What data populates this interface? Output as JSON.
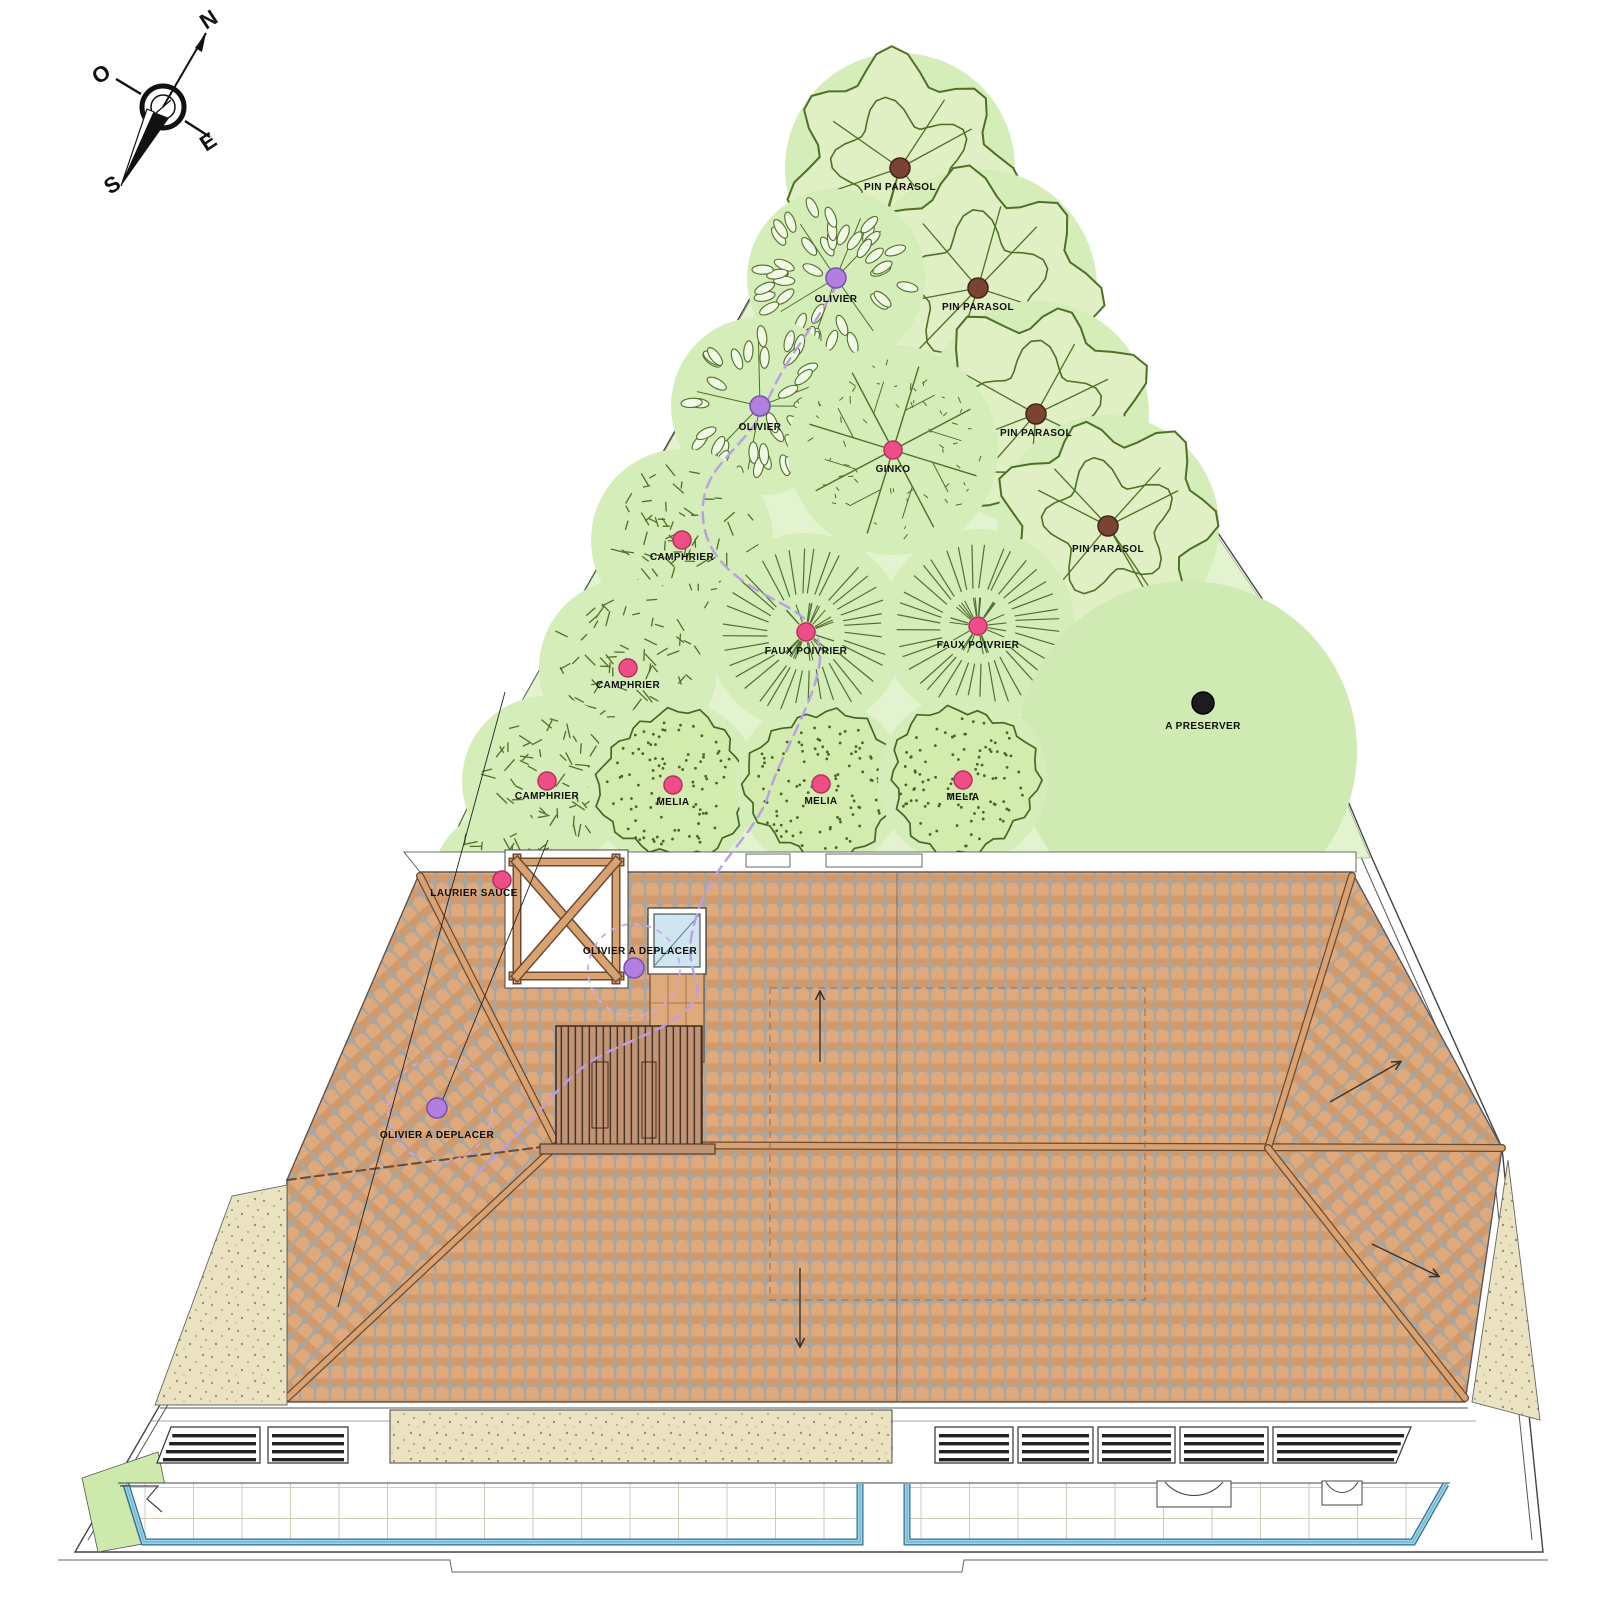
{
  "compass": {
    "north": "N",
    "east": "E",
    "south": "S",
    "west": "O"
  },
  "site": {
    "trees": [
      {
        "label": "PIN PARASOL",
        "type": "pin",
        "x": 900,
        "y": 168,
        "r": 102,
        "dot": "brown",
        "ldy": 22
      },
      {
        "label": "PIN PARASOL",
        "type": "pin",
        "x": 978,
        "y": 288,
        "r": 106,
        "dot": "brown",
        "ldy": 22
      },
      {
        "label": "OLIVIER",
        "type": "olivier",
        "x": 836,
        "y": 278,
        "r": 76,
        "dot": "purple",
        "ldy": 24
      },
      {
        "label": "OLIVIER",
        "type": "olivier",
        "x": 760,
        "y": 406,
        "r": 76,
        "dot": "purple",
        "ldy": 24
      },
      {
        "label": "PIN PARASOL",
        "type": "pin",
        "x": 1036,
        "y": 414,
        "r": 100,
        "dot": "brown",
        "ldy": 22
      },
      {
        "label": "GINKO",
        "type": "ginko",
        "x": 893,
        "y": 450,
        "r": 92,
        "dot": "pink",
        "ldy": 22
      },
      {
        "label": "PIN PARASOL",
        "type": "pin",
        "x": 1108,
        "y": 526,
        "r": 98,
        "dot": "brown",
        "ldy": 26
      },
      {
        "label": "CAMPHRIER",
        "type": "camphrier",
        "x": 682,
        "y": 540,
        "r": 78,
        "dot": "pink",
        "ldy": 20
      },
      {
        "label": "FAUX POIVRIER",
        "type": "poivrier",
        "x": 806,
        "y": 632,
        "r": 86,
        "dot": "pink",
        "ldy": 22
      },
      {
        "label": "FAUX POIVRIER",
        "type": "poivrier",
        "x": 978,
        "y": 626,
        "r": 84,
        "dot": "pink",
        "ldy": 22
      },
      {
        "label": "CAMPHRIER",
        "type": "camphrier",
        "x": 628,
        "y": 668,
        "r": 76,
        "dot": "pink",
        "ldy": 20
      },
      {
        "label": "A PRESERVER",
        "type": "marker",
        "x": 1203,
        "y": 703,
        "r": 0,
        "dot": "black",
        "ldy": 26,
        "halo": 170,
        "halo_dx": -16,
        "halo_dy": 48
      },
      {
        "label": "CAMPHRIER",
        "type": "camphrier",
        "x": 547,
        "y": 781,
        "r": 72,
        "dot": "pink",
        "ldy": 18
      },
      {
        "label": "MELIA",
        "type": "melia",
        "x": 673,
        "y": 785,
        "r": 72,
        "dot": "pink",
        "ldy": 20
      },
      {
        "label": "MELIA",
        "type": "melia",
        "x": 821,
        "y": 784,
        "r": 72,
        "dot": "pink",
        "ldy": 20
      },
      {
        "label": "MELIA",
        "type": "melia",
        "x": 963,
        "y": 780,
        "r": 72,
        "dot": "pink",
        "ldy": 20
      },
      {
        "label": "LAURIER SAUCE",
        "type": "laurier",
        "x": 502,
        "y": 880,
        "r": 56,
        "dot": "pink",
        "ldx": -28,
        "ldy": 16
      },
      {
        "label": "OLIVIER A DEPLACER",
        "type": "marker",
        "x": 634,
        "y": 968,
        "r": 0,
        "dot": "purple",
        "ldx": 6,
        "ldy": -14
      },
      {
        "label": "OLIVIER A DEPLACER",
        "type": "marker",
        "x": 437,
        "y": 1108,
        "r": 0,
        "dot": "purple",
        "ldy": 30
      }
    ]
  },
  "colors": {
    "garden_light": "#e3f2cf",
    "canopy_halo": "#d5edb8",
    "preserve_halo": "#cfeab2",
    "foliage_line": "#4e7026",
    "foliage_fill": "#e0f0c4",
    "leaf_fill": "#f2f8e6",
    "roof_tile": "#e0a97c",
    "roof_tile2": "#d2996a",
    "roof_grout": "#aaa69e",
    "beam": "#d9a272",
    "beam_edge": "#6b4a30",
    "sand": "#ebe2c2",
    "sand_dot": "#9a8f66",
    "pool_blue": "#74b8d4",
    "pool_blue_dark": "#2f6e8c",
    "pool_blue_light": "#9fd4e8",
    "pool_grid": "#ccccbb",
    "wood_deck": "#c29476",
    "wood_line": "#4a3626",
    "skylight_glass": "#cfe6f0",
    "dot_pink": "#ee4d86",
    "dot_purple": "#b07fe0",
    "dot_brown": "#7a4334",
    "dot_black": "#1c1c1c",
    "path_purple": "#b9a0e2",
    "line_dark": "#333333"
  }
}
